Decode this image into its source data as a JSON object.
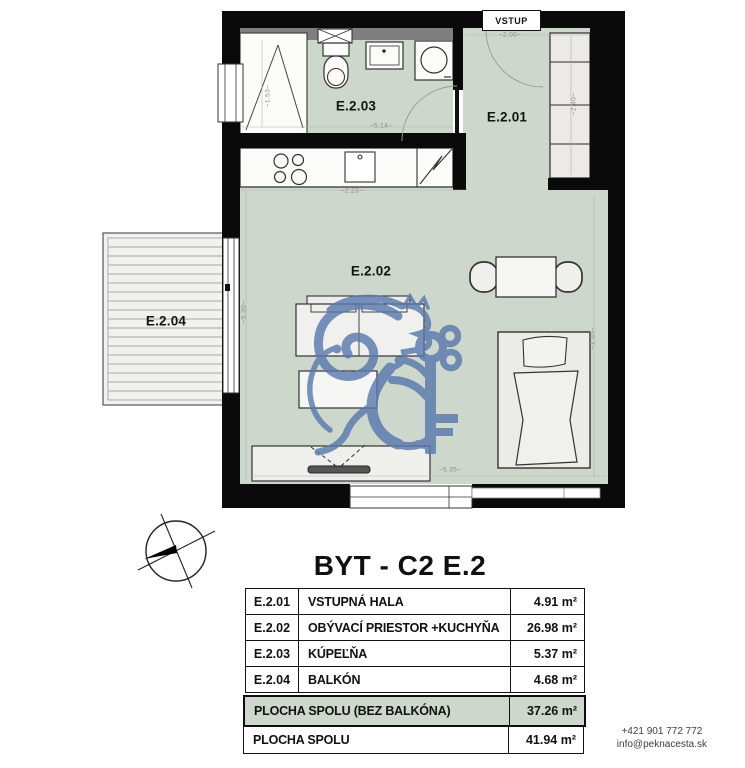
{
  "page_title": "BYT - C2 E.2",
  "plan": {
    "vstup_label": "VSTUP",
    "room_labels": {
      "hall": "E.2.01",
      "living": "E.2.02",
      "bath": "E.2.03",
      "balcony": "E.2.04"
    },
    "dimensions": {
      "entry_width": "~2.00~",
      "bath_width": "~5.14~",
      "bath_height": "~1.53~",
      "wardrobe_height": "~2.40~",
      "living_height": "~5.30~",
      "kitchen_width": "~2.23~",
      "living_width": "~5.35~",
      "bed_width": "~1.65~"
    }
  },
  "table": {
    "rows": [
      {
        "code": "E.2.01",
        "name": "VSTUPNÁ HALA",
        "area": "4.91 m²"
      },
      {
        "code": "E.2.02",
        "name": "OBÝVACÍ PRIESTOR +KUCHYŇA",
        "area": "26.98 m²"
      },
      {
        "code": "E.2.03",
        "name": "KÚPEĽŇA",
        "area": "5.37 m²"
      },
      {
        "code": "E.2.04",
        "name": "BALKÓN",
        "area": "4.68 m²"
      }
    ],
    "summary": [
      {
        "label": "PLOCHA SPOLU (BEZ BALKÓNA)",
        "area": "37.26 m²",
        "highlighted": true
      },
      {
        "label": "PLOCHA SPOLU",
        "area": "41.94 m²",
        "highlighted": false
      }
    ]
  },
  "contact": {
    "phone": "+421 901 772 772",
    "email": "info@peknacesta.sk"
  },
  "colors": {
    "room_fill": "#cdd7cb",
    "wall": "#0a0a0a",
    "watermark_blue": "#5878ad",
    "highlight_row": "#cdd7cb",
    "gray_strip": "#7f7f7f"
  }
}
